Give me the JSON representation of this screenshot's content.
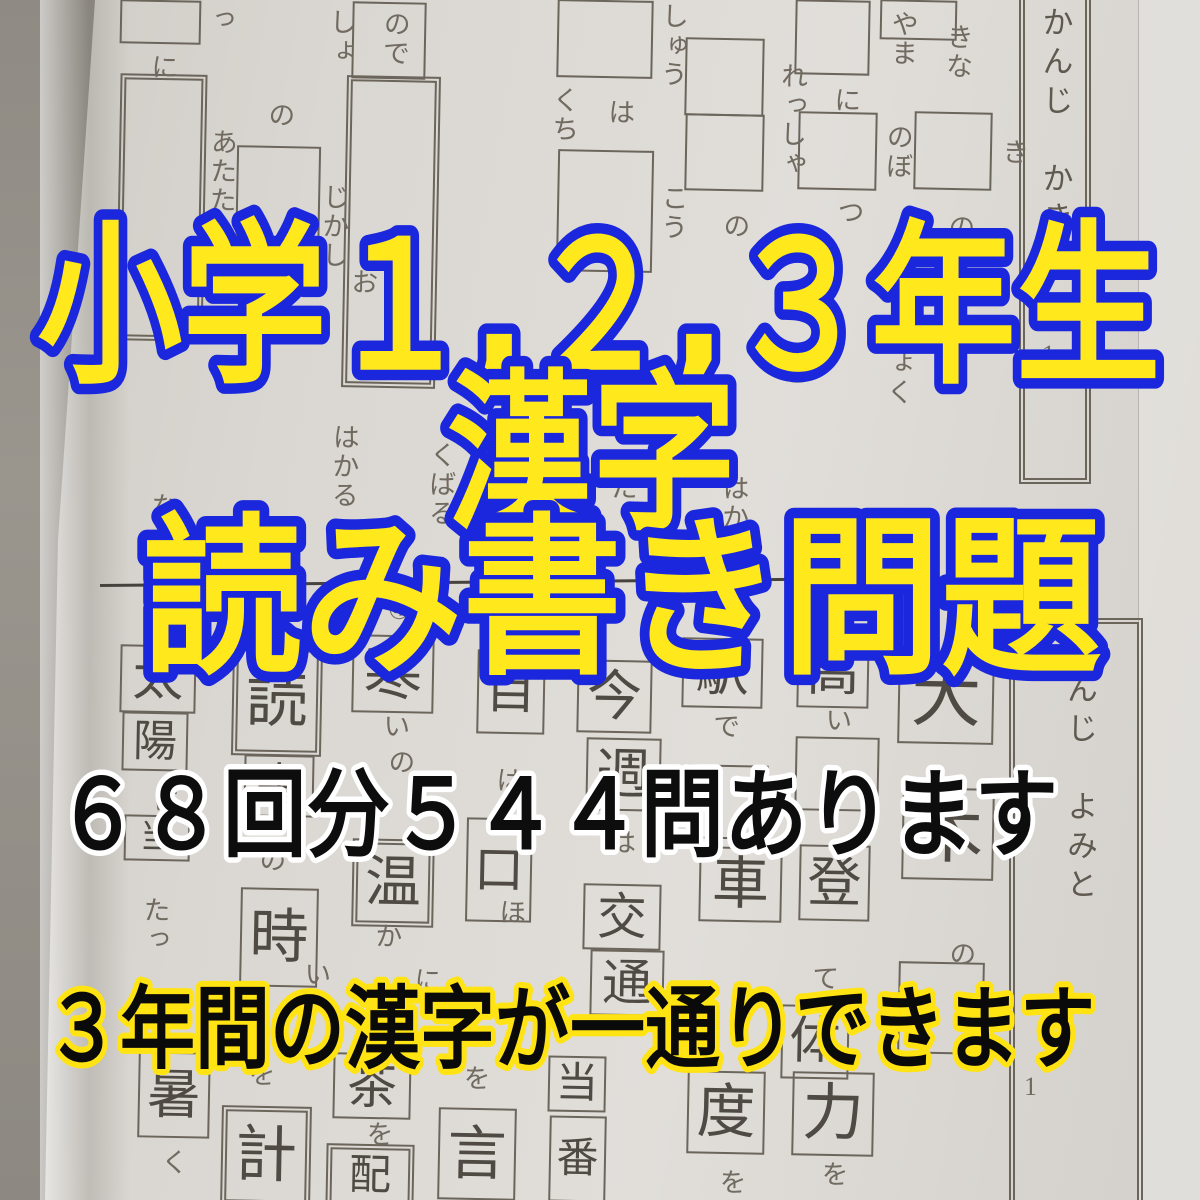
{
  "overlay": {
    "line1": "小学１,２,３年生",
    "line2": "漢字",
    "line3": "読み書き問題",
    "line4": "６８回分５４４問あります",
    "line5": "３年間の漢字が一通りできます",
    "colors": {
      "title_fill": "#ffe81c",
      "title_stroke": "#1b27dd",
      "count_fill": "#0d0d0d",
      "count_stroke": "#ffffff",
      "coverage_fill": "#0a0a0a",
      "coverage_stroke": "#ffe312"
    }
  },
  "sheet_top": {
    "title": "かんじ　かき",
    "title_number": "1",
    "boxes": [
      {
        "x": 120,
        "y": 0,
        "w": 77,
        "h": 40
      },
      {
        "x": 122,
        "y": 78,
        "w": 75,
        "h": 255,
        "d": 1
      },
      {
        "x": 236,
        "y": 146,
        "w": 80,
        "h": 115
      },
      {
        "x": 352,
        "y": 2,
        "w": 70,
        "h": 73
      },
      {
        "x": 348,
        "y": 80,
        "w": 82,
        "h": 300,
        "d": 1
      },
      {
        "x": 557,
        "y": 0,
        "w": 92,
        "h": 74
      },
      {
        "x": 557,
        "y": 150,
        "w": 92,
        "h": 118
      },
      {
        "x": 685,
        "y": 38,
        "w": 75,
        "h": 74
      },
      {
        "x": 685,
        "y": 114,
        "w": 75,
        "h": 73
      },
      {
        "x": 795,
        "y": 0,
        "w": 71,
        "h": 71
      },
      {
        "x": 798,
        "y": 112,
        "w": 75,
        "h": 74
      },
      {
        "x": 914,
        "y": 112,
        "w": 74,
        "h": 74
      },
      {
        "x": 880,
        "y": 0,
        "w": 73,
        "h": 36
      }
    ],
    "snippets": [
      {
        "t": "っ",
        "x": 205,
        "y": 5
      },
      {
        "t": "しょ",
        "x": 326,
        "y": 8
      },
      {
        "t": "ので",
        "x": 380,
        "y": 10
      },
      {
        "t": "に",
        "x": 148,
        "y": 53
      },
      {
        "t": "の",
        "x": 265,
        "y": 101
      },
      {
        "t": "しゅう",
        "x": 658,
        "y": 2
      },
      {
        "t": "くち",
        "x": 549,
        "y": 86
      },
      {
        "t": "は",
        "x": 605,
        "y": 98
      },
      {
        "t": "れっしゃ",
        "x": 777,
        "y": 62
      },
      {
        "t": "に",
        "x": 831,
        "y": 86
      },
      {
        "t": "やま",
        "x": 888,
        "y": 10
      },
      {
        "t": "のぼ",
        "x": 883,
        "y": 123
      },
      {
        "t": "きな",
        "x": 943,
        "y": 23
      },
      {
        "t": "き",
        "x": 999,
        "y": 138
      },
      {
        "t": "の",
        "x": 945,
        "y": 213
      },
      {
        "t": "こう",
        "x": 658,
        "y": 184
      },
      {
        "t": "の",
        "x": 720,
        "y": 212
      },
      {
        "t": "つ",
        "x": 834,
        "y": 198
      },
      {
        "t": "あたた",
        "x": 207,
        "y": 128
      },
      {
        "t": "じかし",
        "x": 319,
        "y": 183
      },
      {
        "t": "お",
        "x": 348,
        "y": 268
      },
      {
        "t": "はかる",
        "x": 329,
        "y": 423
      },
      {
        "t": "くばる",
        "x": 426,
        "y": 441
      },
      {
        "t": "や",
        "x": 499,
        "y": 350
      },
      {
        "t": "だ",
        "x": 608,
        "y": 473
      },
      {
        "t": "はか",
        "x": 719,
        "y": 474
      },
      {
        "t": "ど",
        "x": 779,
        "y": 358
      },
      {
        "t": "た",
        "x": 879,
        "y": 274
      },
      {
        "t": "りょく",
        "x": 884,
        "y": 320
      },
      {
        "t": "な",
        "x": 148,
        "y": 492
      },
      {
        "t": "る",
        "x": 442,
        "y": 507
      }
    ],
    "numbers": []
  },
  "sheet_bottom": {
    "title": "かんじ　よみと",
    "title_number": "1",
    "range_label": "〜3",
    "boxes": [
      {
        "x": 898,
        "y": 652,
        "w": 92,
        "h": 88,
        "k": "大"
      },
      {
        "x": 902,
        "y": 788,
        "w": 88,
        "h": 88,
        "k": "木"
      },
      {
        "x": 898,
        "y": 962,
        "w": 82,
        "h": 88
      },
      {
        "x": 797,
        "y": 638,
        "w": 68,
        "h": 66,
        "k": "高"
      },
      {
        "x": 795,
        "y": 737,
        "w": 80,
        "h": 70
      },
      {
        "x": 799,
        "y": 845,
        "w": 67,
        "h": 72,
        "k": "登"
      },
      {
        "x": 781,
        "y": 1005,
        "w": 64,
        "h": 70,
        "k": "体"
      },
      {
        "x": 792,
        "y": 1072,
        "w": 78,
        "h": 80,
        "k": "力"
      },
      {
        "x": 682,
        "y": 638,
        "w": 77,
        "h": 66,
        "k": "駅"
      },
      {
        "x": 687,
        "y": 765,
        "w": 77,
        "h": 70
      },
      {
        "x": 699,
        "y": 847,
        "w": 79,
        "h": 71,
        "k": "車"
      },
      {
        "x": 687,
        "y": 1071,
        "w": 74,
        "h": 79,
        "k": "度"
      },
      {
        "x": 577,
        "y": 660,
        "w": 71,
        "h": 69,
        "k": "今"
      },
      {
        "x": 586,
        "y": 738,
        "w": 71,
        "h": 69,
        "k": "週"
      },
      {
        "x": 583,
        "y": 884,
        "w": 74,
        "h": 62,
        "k": "交"
      },
      {
        "x": 590,
        "y": 950,
        "w": 70,
        "h": 62,
        "k": "通"
      },
      {
        "x": 548,
        "y": 1056,
        "w": 54,
        "h": 52,
        "k": "当"
      },
      {
        "x": 549,
        "y": 1116,
        "w": 53,
        "h": 82,
        "k": "番"
      },
      {
        "x": 477,
        "y": 650,
        "w": 64,
        "h": 80,
        "k": "目"
      },
      {
        "x": 466,
        "y": 818,
        "w": 62,
        "h": 100,
        "k": "口"
      },
      {
        "x": 438,
        "y": 1108,
        "w": 74,
        "h": 88,
        "k": "言"
      },
      {
        "x": 352,
        "y": 635,
        "w": 78,
        "h": 74,
        "k": "寒"
      },
      {
        "x": 356,
        "y": 843,
        "w": 70,
        "h": 76,
        "k": "温",
        "d": 1
      },
      {
        "x": 333,
        "y": 1053,
        "w": 74,
        "h": 62,
        "k": "茶"
      },
      {
        "x": 330,
        "y": 1148,
        "w": 76,
        "h": 52,
        "k": "配",
        "d": 1
      },
      {
        "x": 236,
        "y": 650,
        "w": 78,
        "h": 98,
        "k": "読",
        "d": 1
      },
      {
        "x": 244,
        "y": 755,
        "w": 66,
        "h": 58,
        "k": "書"
      },
      {
        "x": 240,
        "y": 888,
        "w": 74,
        "h": 95,
        "k": "時"
      },
      {
        "x": 225,
        "y": 1110,
        "w": 78,
        "h": 88,
        "k": "計",
        "d": 1
      },
      {
        "x": 120,
        "y": 645,
        "w": 72,
        "h": 64,
        "k": "太"
      },
      {
        "x": 122,
        "y": 712,
        "w": 62,
        "h": 55,
        "k": "陽"
      },
      {
        "x": 124,
        "y": 815,
        "w": 62,
        "h": 42,
        "k": "当"
      },
      {
        "x": 138,
        "y": 1052,
        "w": 68,
        "h": 82,
        "k": "暑"
      }
    ],
    "snippets": [
      {
        "t": "い",
        "x": 380,
        "y": 712
      },
      {
        "t": "の",
        "x": 385,
        "y": 748
      },
      {
        "t": "か",
        "x": 372,
        "y": 922
      },
      {
        "t": "を",
        "x": 363,
        "y": 1120
      },
      {
        "t": "い",
        "x": 822,
        "y": 706
      },
      {
        "t": "て",
        "x": 809,
        "y": 964
      },
      {
        "t": "を",
        "x": 818,
        "y": 1160
      },
      {
        "t": "で",
        "x": 710,
        "y": 712
      },
      {
        "t": "を",
        "x": 716,
        "y": 1168
      },
      {
        "t": "は",
        "x": 606,
        "y": 828
      },
      {
        "t": "は",
        "x": 493,
        "y": 766
      },
      {
        "t": "ほ",
        "x": 496,
        "y": 898
      },
      {
        "t": "に",
        "x": 411,
        "y": 966
      },
      {
        "t": "を",
        "x": 460,
        "y": 1064
      },
      {
        "t": "の",
        "x": 946,
        "y": 940
      },
      {
        "t": "の",
        "x": 256,
        "y": 846
      },
      {
        "t": "を",
        "x": 245,
        "y": 1060
      },
      {
        "t": "に",
        "x": 150,
        "y": 786
      },
      {
        "t": "たっ",
        "x": 140,
        "y": 896
      },
      {
        "t": "く",
        "x": 158,
        "y": 1148
      },
      {
        "t": "い",
        "x": 301,
        "y": 960
      }
    ],
    "numbers": [
      {
        "t": "⑦",
        "x": 192,
        "y": 596
      },
      {
        "t": "⑥",
        "x": 258,
        "y": 598
      },
      {
        "t": "④",
        "x": 388,
        "y": 596
      },
      {
        "t": "③",
        "x": 456,
        "y": 600
      }
    ]
  }
}
